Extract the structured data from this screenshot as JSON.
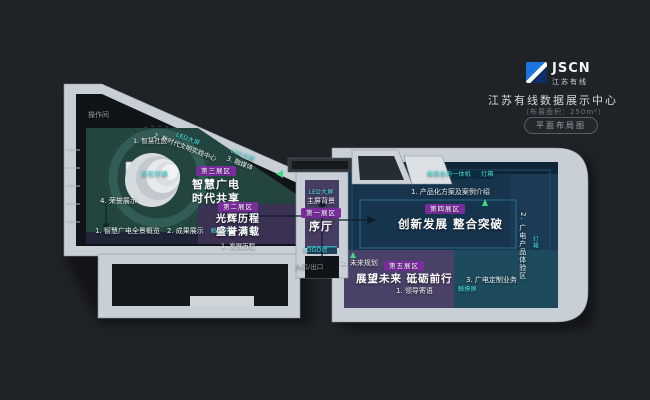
{
  "header": {
    "brand": "JSCN",
    "brand_cn": "江苏有线",
    "title": "江苏有线数据展示中心",
    "area_note": "（布展面积：250m²）",
    "view_label": "平面布局图"
  },
  "plan": {
    "operation_room": "操作间",
    "entrance": "入口/出口",
    "zone1": {
      "badge": "第一展区",
      "name": "序厅",
      "screen_tag": "LED大屏",
      "screen": "主屏背景",
      "logo_wall": "LOGO墙"
    },
    "zone2": {
      "badge": "第二展区",
      "title1": "光辉历程",
      "title2": "盛誉满载",
      "item1": "1. 发展历程"
    },
    "zone3": {
      "badge": "第三展区",
      "title1": "智慧广电",
      "title2": "时代共享",
      "item1": "1. 智慧社区",
      "item2": "2. 新时代文明实践中心",
      "item2_tag": "LED大屏",
      "item3": "3. 融媒体",
      "item3_tag": "LED大屏",
      "item4": "4. 荣誉展示",
      "item5": "1. 智慧广电全景概览",
      "item6": "2. 成果展示",
      "item6_tag": "触摸查询一体机",
      "feature": "异形环幕"
    },
    "zone4": {
      "badge": "第四展区",
      "title": "创新发展  整合突破",
      "tag1": "触摸查询一体机",
      "tag2": "灯箱",
      "item1": "1. 产品化方案及案例介绍",
      "item2": "2. 广电产品体验区",
      "item2_tag": "灯箱"
    },
    "zone5": {
      "badge": "第五展区",
      "title": "展望未来  砥砺前行",
      "item1": "1. 领导寄语",
      "item2": "2. 未来规划",
      "item3": "3. 广电定制业务",
      "item3_tag": "触摸屏"
    }
  },
  "colors": {
    "background": "#1f2327",
    "accent_cyan": "#45e6e0",
    "badge_purple": "#7b2d9e",
    "logo_blue": "#1b74e0",
    "zone_teal": "#24453f",
    "zone_navy": "#17344d",
    "zone_purple": "#473c62",
    "wall_light": "#c9cfd6"
  }
}
